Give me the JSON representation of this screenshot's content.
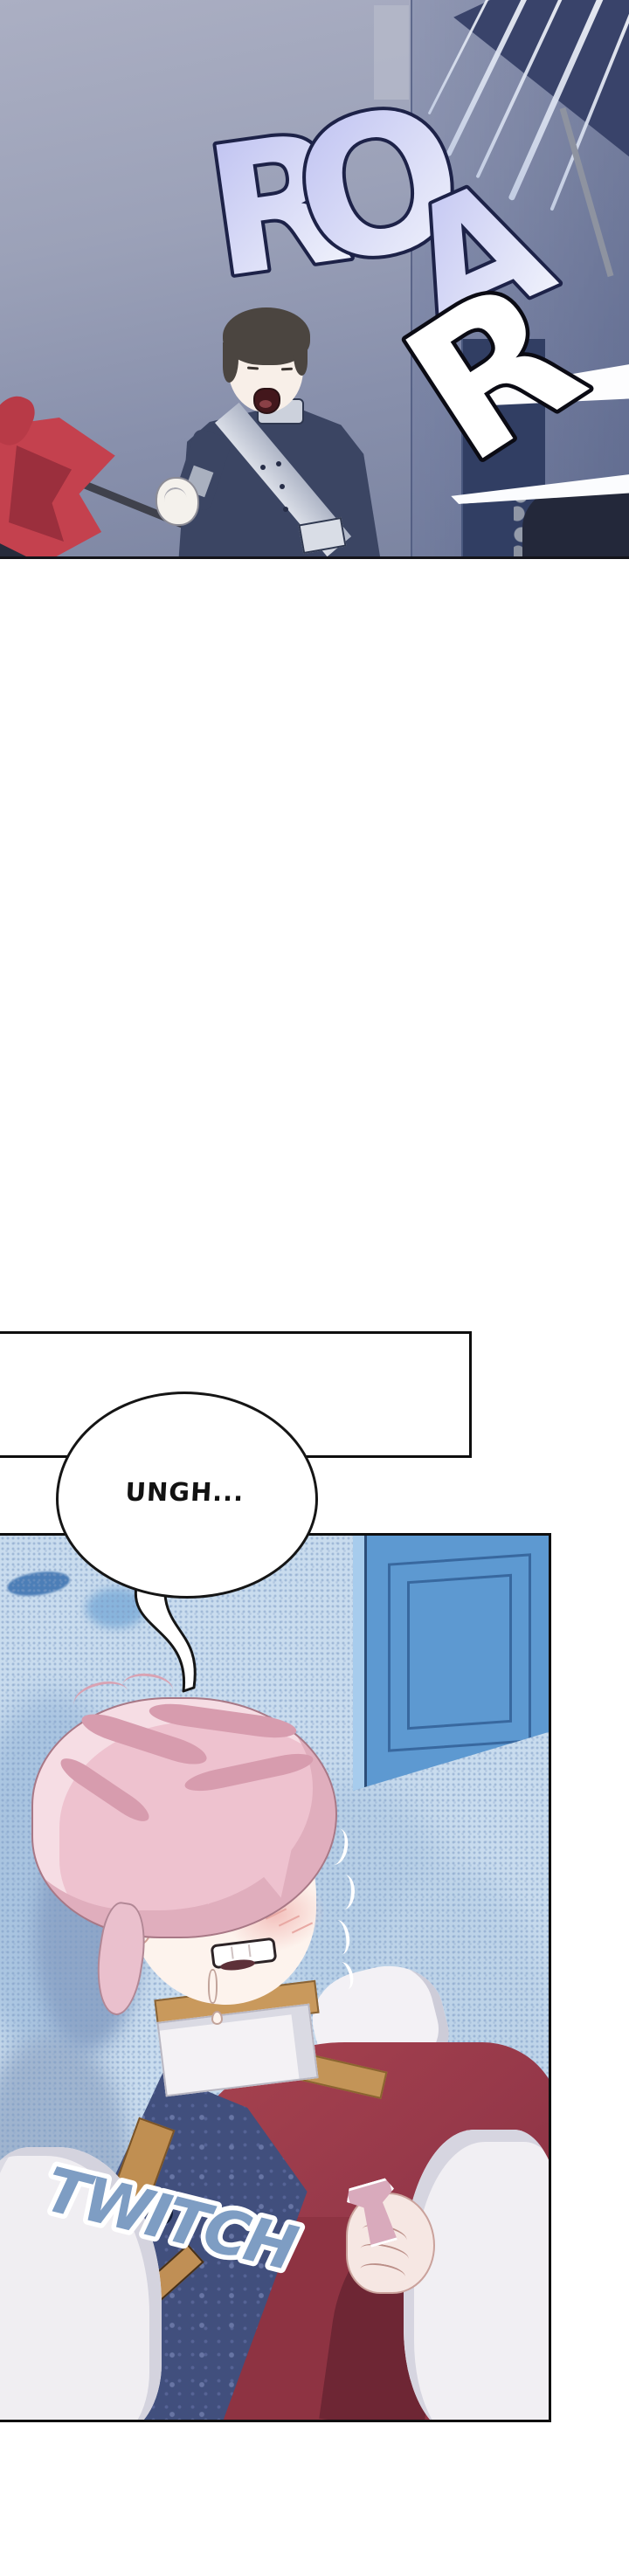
{
  "page": {
    "type": "webtoon-episode-segment",
    "background": "#ffffff",
    "panel_count": 3
  },
  "panels": [
    {
      "name": "battle-roar",
      "description": "soldier in navy uniform with silver sash shouting and gripping a flag lance, monster roar sfx, speed lines"
    },
    {
      "name": "blank-transition",
      "description": "empty white bordered panel"
    },
    {
      "name": "collapsed-boy",
      "description": "pink-haired boy lying unconscious, gritted teeth, tear, blue door behind, hand clutching a small vial"
    }
  ],
  "sfx": {
    "roar": {
      "word": "ROAR",
      "letters": [
        "R",
        "O",
        "A",
        "R"
      ],
      "fill": "#c6c9f3",
      "fill_light": "#eef0fb",
      "outline": "#1d2248",
      "last_letter_fill": "#ffffff",
      "last_letter_outline": "#0b0b14"
    },
    "twitch": {
      "text": "TWITCH",
      "fill": "#7e9dc3",
      "outline": "#ffffff"
    }
  },
  "dialogue": {
    "ungh": "UNGH..."
  },
  "palette": {
    "top_panel_bg_top": "#abafc3",
    "top_panel_bg_bottom": "#79829f",
    "uniform_navy": "#3b4563",
    "sash_silver": "#dadee7",
    "flag_red": "#c4414e",
    "panel_border": "#0f0f0f",
    "bottom_panel_bg": "#c9dcee",
    "door_blue": "#5d99d1",
    "door_line": "#38689f",
    "hair_pink": "#eec2cf",
    "skin": "#fdf3ed",
    "blush": "#f3c1bd",
    "vest_navy": "#414f7d",
    "gold_trim": "#c39457",
    "coat_red": "#97394a",
    "shirt_white": "#f1eff3",
    "vial_mauve": "#d9aabc"
  }
}
